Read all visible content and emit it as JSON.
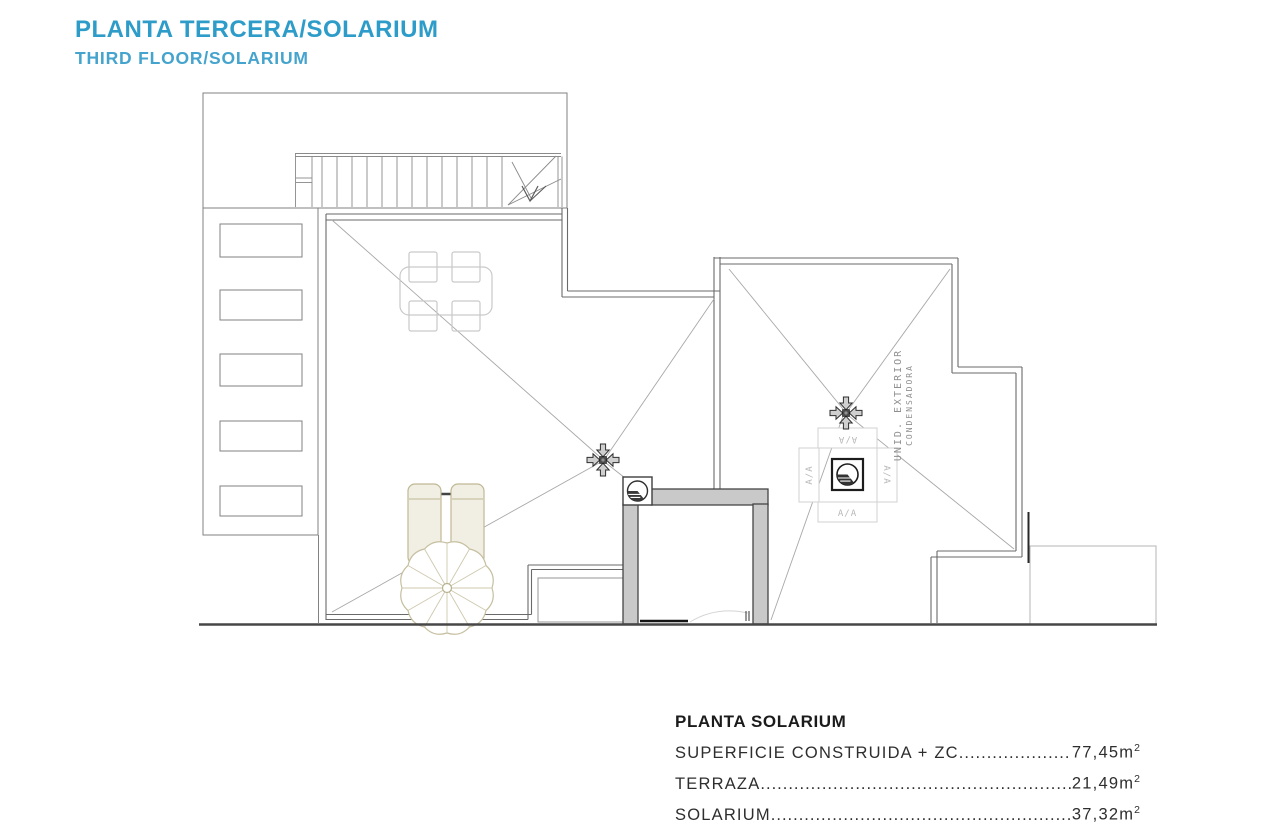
{
  "header": {
    "title": "PLANTA TERCERA/SOLARIUM",
    "subtitle": "THIRD FLOOR/SOLARIUM"
  },
  "legend": {
    "title": "PLANTA SOLARIUM",
    "rows": [
      {
        "label": "SUPERFICIE CONSTRUIDA + ZC",
        "value": "77,45m",
        "sup": "2"
      },
      {
        "label": "TERRAZA",
        "value": "21,49m",
        "sup": "2"
      },
      {
        "label": "SOLARIUM",
        "value": "37,32m",
        "sup": "2"
      }
    ]
  },
  "plan": {
    "aa_label": "A/A",
    "condenser_line1": "UNID. EXTERIOR",
    "condenser_line2": "CONDENSADORA"
  },
  "colors": {
    "title_blue": "#2E9CC9",
    "subtitle_blue": "#45A4CD",
    "wall_gray": "#6a6a6a",
    "elevator_fill": "#c9c9c9",
    "furniture_beige": "#c0b894",
    "ink": "#2e2e2e"
  }
}
